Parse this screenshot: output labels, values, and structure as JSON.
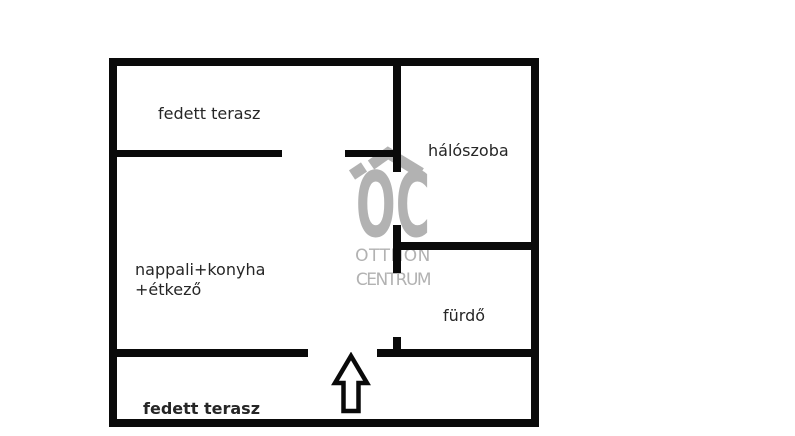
{
  "colors": {
    "background": "#ffffff",
    "wall": "#0a0a0a",
    "label": "#262626",
    "watermark": "#b2b2b2"
  },
  "watermark": {
    "monogram": "OC",
    "line1": "OTTHON",
    "line2": "CENTRUM"
  },
  "floorplan": {
    "rooms": [
      {
        "name": "terrace-top",
        "label": "fedett terasz"
      },
      {
        "name": "bedroom",
        "label": "hálószoba"
      },
      {
        "name": "living-kitchen-dining",
        "line1": "nappali+konyha",
        "line2": "+étkező"
      },
      {
        "name": "bathroom",
        "label": "fürdő"
      },
      {
        "name": "terrace-bottom",
        "label": "fedett terasz"
      }
    ],
    "entrance_arrow": {
      "direction": "up"
    },
    "walls": [
      {
        "name": "outer-top",
        "x": 109,
        "y": 58,
        "w": 430,
        "h": 8
      },
      {
        "name": "outer-left",
        "x": 109,
        "y": 58,
        "w": 8,
        "h": 369
      },
      {
        "name": "outer-right",
        "x": 531,
        "y": 58,
        "w": 8,
        "h": 369
      },
      {
        "name": "outer-bottom",
        "x": 109,
        "y": 419,
        "w": 430,
        "h": 8
      },
      {
        "name": "bedroom-divider-upper",
        "x": 393,
        "y": 58,
        "w": 8,
        "h": 114
      },
      {
        "name": "bedroom-divider-lower",
        "x": 393,
        "y": 225,
        "w": 8,
        "h": 48
      },
      {
        "name": "bathroom-divider-stub",
        "x": 393,
        "y": 337,
        "w": 8,
        "h": 18
      },
      {
        "name": "terrace-top-divider-left",
        "x": 109,
        "y": 150,
        "w": 173,
        "h": 7
      },
      {
        "name": "terrace-top-divider-right",
        "x": 345,
        "y": 150,
        "w": 56,
        "h": 7
      },
      {
        "name": "bedroom-bathroom-divider",
        "x": 393,
        "y": 242,
        "w": 146,
        "h": 8
      },
      {
        "name": "terrace-bottom-divider-left",
        "x": 109,
        "y": 349,
        "w": 199,
        "h": 8
      },
      {
        "name": "terrace-bottom-divider-right",
        "x": 377,
        "y": 349,
        "w": 162,
        "h": 8
      }
    ]
  }
}
